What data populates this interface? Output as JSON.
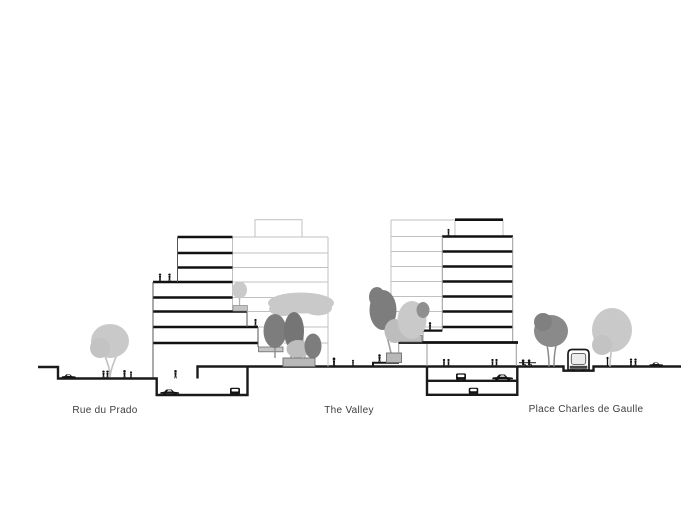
{
  "drawing": {
    "labels": {
      "left_street": "Rue du Prado",
      "center_plaza": "The Valley",
      "right_plaza": "Place Charles de Gaulle"
    },
    "colors": {
      "section_line": "#1a1a1a",
      "thin_facade_line": "#c0c0c0",
      "tree_light": "#c9c9c9",
      "tree_dark": "#7d7d7d",
      "planter": "#b8b8b8",
      "label_text": "#3d3d3d",
      "background": "#ffffff"
    }
  }
}
